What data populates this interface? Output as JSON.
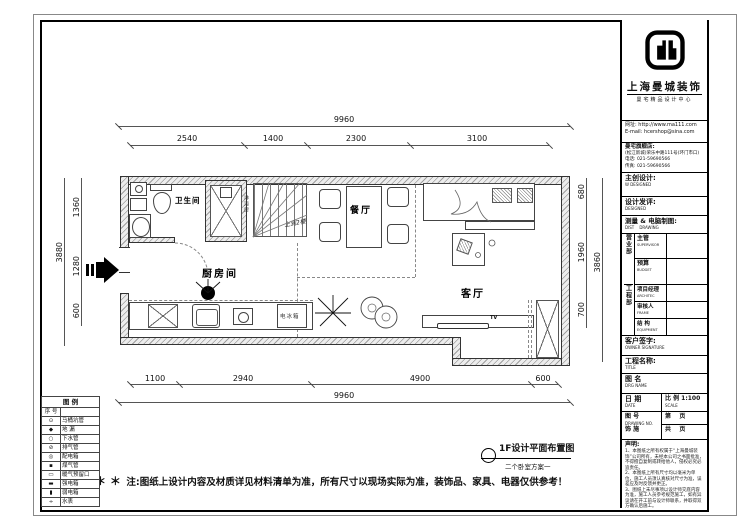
{
  "note": {
    "stars": "＊ ＊",
    "text": "注:图纸上设计内容及材质详见材料清单为准，所有尺寸以现场实际为准，装饰品、家具、电器仅供参考！"
  },
  "plan_title": {
    "main": "1F设计平面布置图",
    "sub": "二个卧室方案一"
  },
  "rooms": {
    "bath": "卫生间",
    "dining": "餐厅",
    "kitchen": "厨房间",
    "living": "客厅",
    "shower": "淋浴房",
    "stair_note": "上到2楼",
    "tv": "TV",
    "fridge": "电冰箱"
  },
  "dims": {
    "top_total": "9960",
    "top": [
      "2540",
      "1400",
      "2300",
      "3100"
    ],
    "bottom": [
      "1100",
      "2940",
      "4900",
      "600"
    ],
    "bottom_total": "9960",
    "left_total": "3880",
    "left": [
      "1360",
      "1280",
      "600"
    ],
    "right": [
      "680",
      "1960",
      "700"
    ],
    "right_total": "3860"
  },
  "legend": {
    "title": "图 例",
    "col_no": "序 号",
    "rows": [
      {
        "glyph": "⊙",
        "label": "马桶坑管"
      },
      {
        "glyph": "◆",
        "label": "地 漏"
      },
      {
        "glyph": "○",
        "label": "下水管"
      },
      {
        "glyph": "⊘",
        "label": "排气管"
      },
      {
        "glyph": "◎",
        "label": "配电箱"
      },
      {
        "glyph": "▪",
        "label": "煤气管"
      },
      {
        "glyph": "▭",
        "label": "暖气预留口"
      },
      {
        "glyph": "▬",
        "label": "强电箱"
      },
      {
        "glyph": "▮",
        "label": "弱电箱"
      },
      {
        "glyph": "÷",
        "label": "水表"
      }
    ]
  },
  "title_block": {
    "company": "上海曼城装饰",
    "company_sub": "曼宅精品设计中心",
    "website": "网址: http://www.ma111.com",
    "email": "E-mail: hcershop@sina.com",
    "store": "曼宅旗舰店:",
    "address": "(松江新城)荣乐中路111号(环门市口)",
    "phone": "电话: 021-59690566",
    "fax": "传真: 021-59690566",
    "chief_design": "主创设计:",
    "chief_design_en": "W DESIGNED",
    "design_review": "设计发评:",
    "design_review_en": "DESIGNED",
    "survey": "测量 & 电脑制图:",
    "survey_en": "DIST    DRAWING",
    "dept_sales": "营业部",
    "supervisor": "主管",
    "supervisor_en": "SUPERVISOR",
    "budget": "预算",
    "budget_en": "BUDGET",
    "dept_eng": "工程部",
    "pm": "项目经理",
    "pm_en": "ARCHITEC",
    "auditor": "审核人",
    "auditor_en": "FRAME",
    "structure": "结 构",
    "structure_en": "EQUIPMENT",
    "owner_sign": "客户签字:",
    "owner_sign_en": "OWNER SIGNATURE",
    "project_name": "工程名称:",
    "project_name_en": "TITLE",
    "drg_name": "图 名",
    "drg_name_en": "DRG NAME",
    "date": "日 期",
    "date_en": "DATE",
    "scale": "比 例 1:100",
    "scale_en": "SCALE",
    "drawing_no": "图 号",
    "drawing_no_en": "DRAWING NO.",
    "deco": "饰 施",
    "page_no": "第    页",
    "total_pages": "共    页",
    "statement_title": "声明:",
    "statement_lines": [
      "1、本图纸之所有权属于“上海曼城装饰”公司所有，未经本公司之书面批准，不得擅自复制或转给他人，侵权必究必追责任。",
      "2、本图纸上所有尺寸均以毫米为单位，施工人员须认真核对尺寸为准，误差应及时反馈并更正。",
      "3、图纸上未尽事项以设计师交底内容为准，施工人员参考规范施工，如有异议请在开工前与设计师联系，并取得双方确认后施工。"
    ]
  }
}
